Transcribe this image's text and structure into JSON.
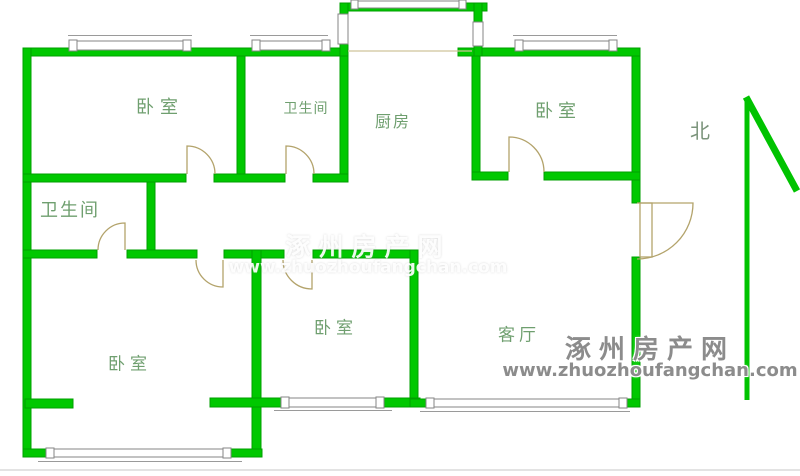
{
  "floorplan": {
    "rooms": [
      {
        "id": "bedroom-top-left",
        "label": "卧室"
      },
      {
        "id": "bathroom-top",
        "label": "卫生间"
      },
      {
        "id": "kitchen",
        "label": "厨房"
      },
      {
        "id": "bedroom-top-right",
        "label": "卧室"
      },
      {
        "id": "bathroom-left",
        "label": "卫生间"
      },
      {
        "id": "bedroom-middle",
        "label": "卧室"
      },
      {
        "id": "bedroom-bottom-left",
        "label": "卧室"
      },
      {
        "id": "living-room",
        "label": "客厅"
      }
    ],
    "compass": {
      "label": "北"
    },
    "colors": {
      "wall": "#00c800",
      "wall_edge": "#009f00",
      "room_label": "#6f9f6f",
      "door_line": "#b3a36b",
      "window_frame": "#858585",
      "watermark_gray": "#8c8c8c"
    }
  },
  "watermark": {
    "site_name": "涿州房产网",
    "site_url": "www.zhuozhoufangchan.com"
  }
}
